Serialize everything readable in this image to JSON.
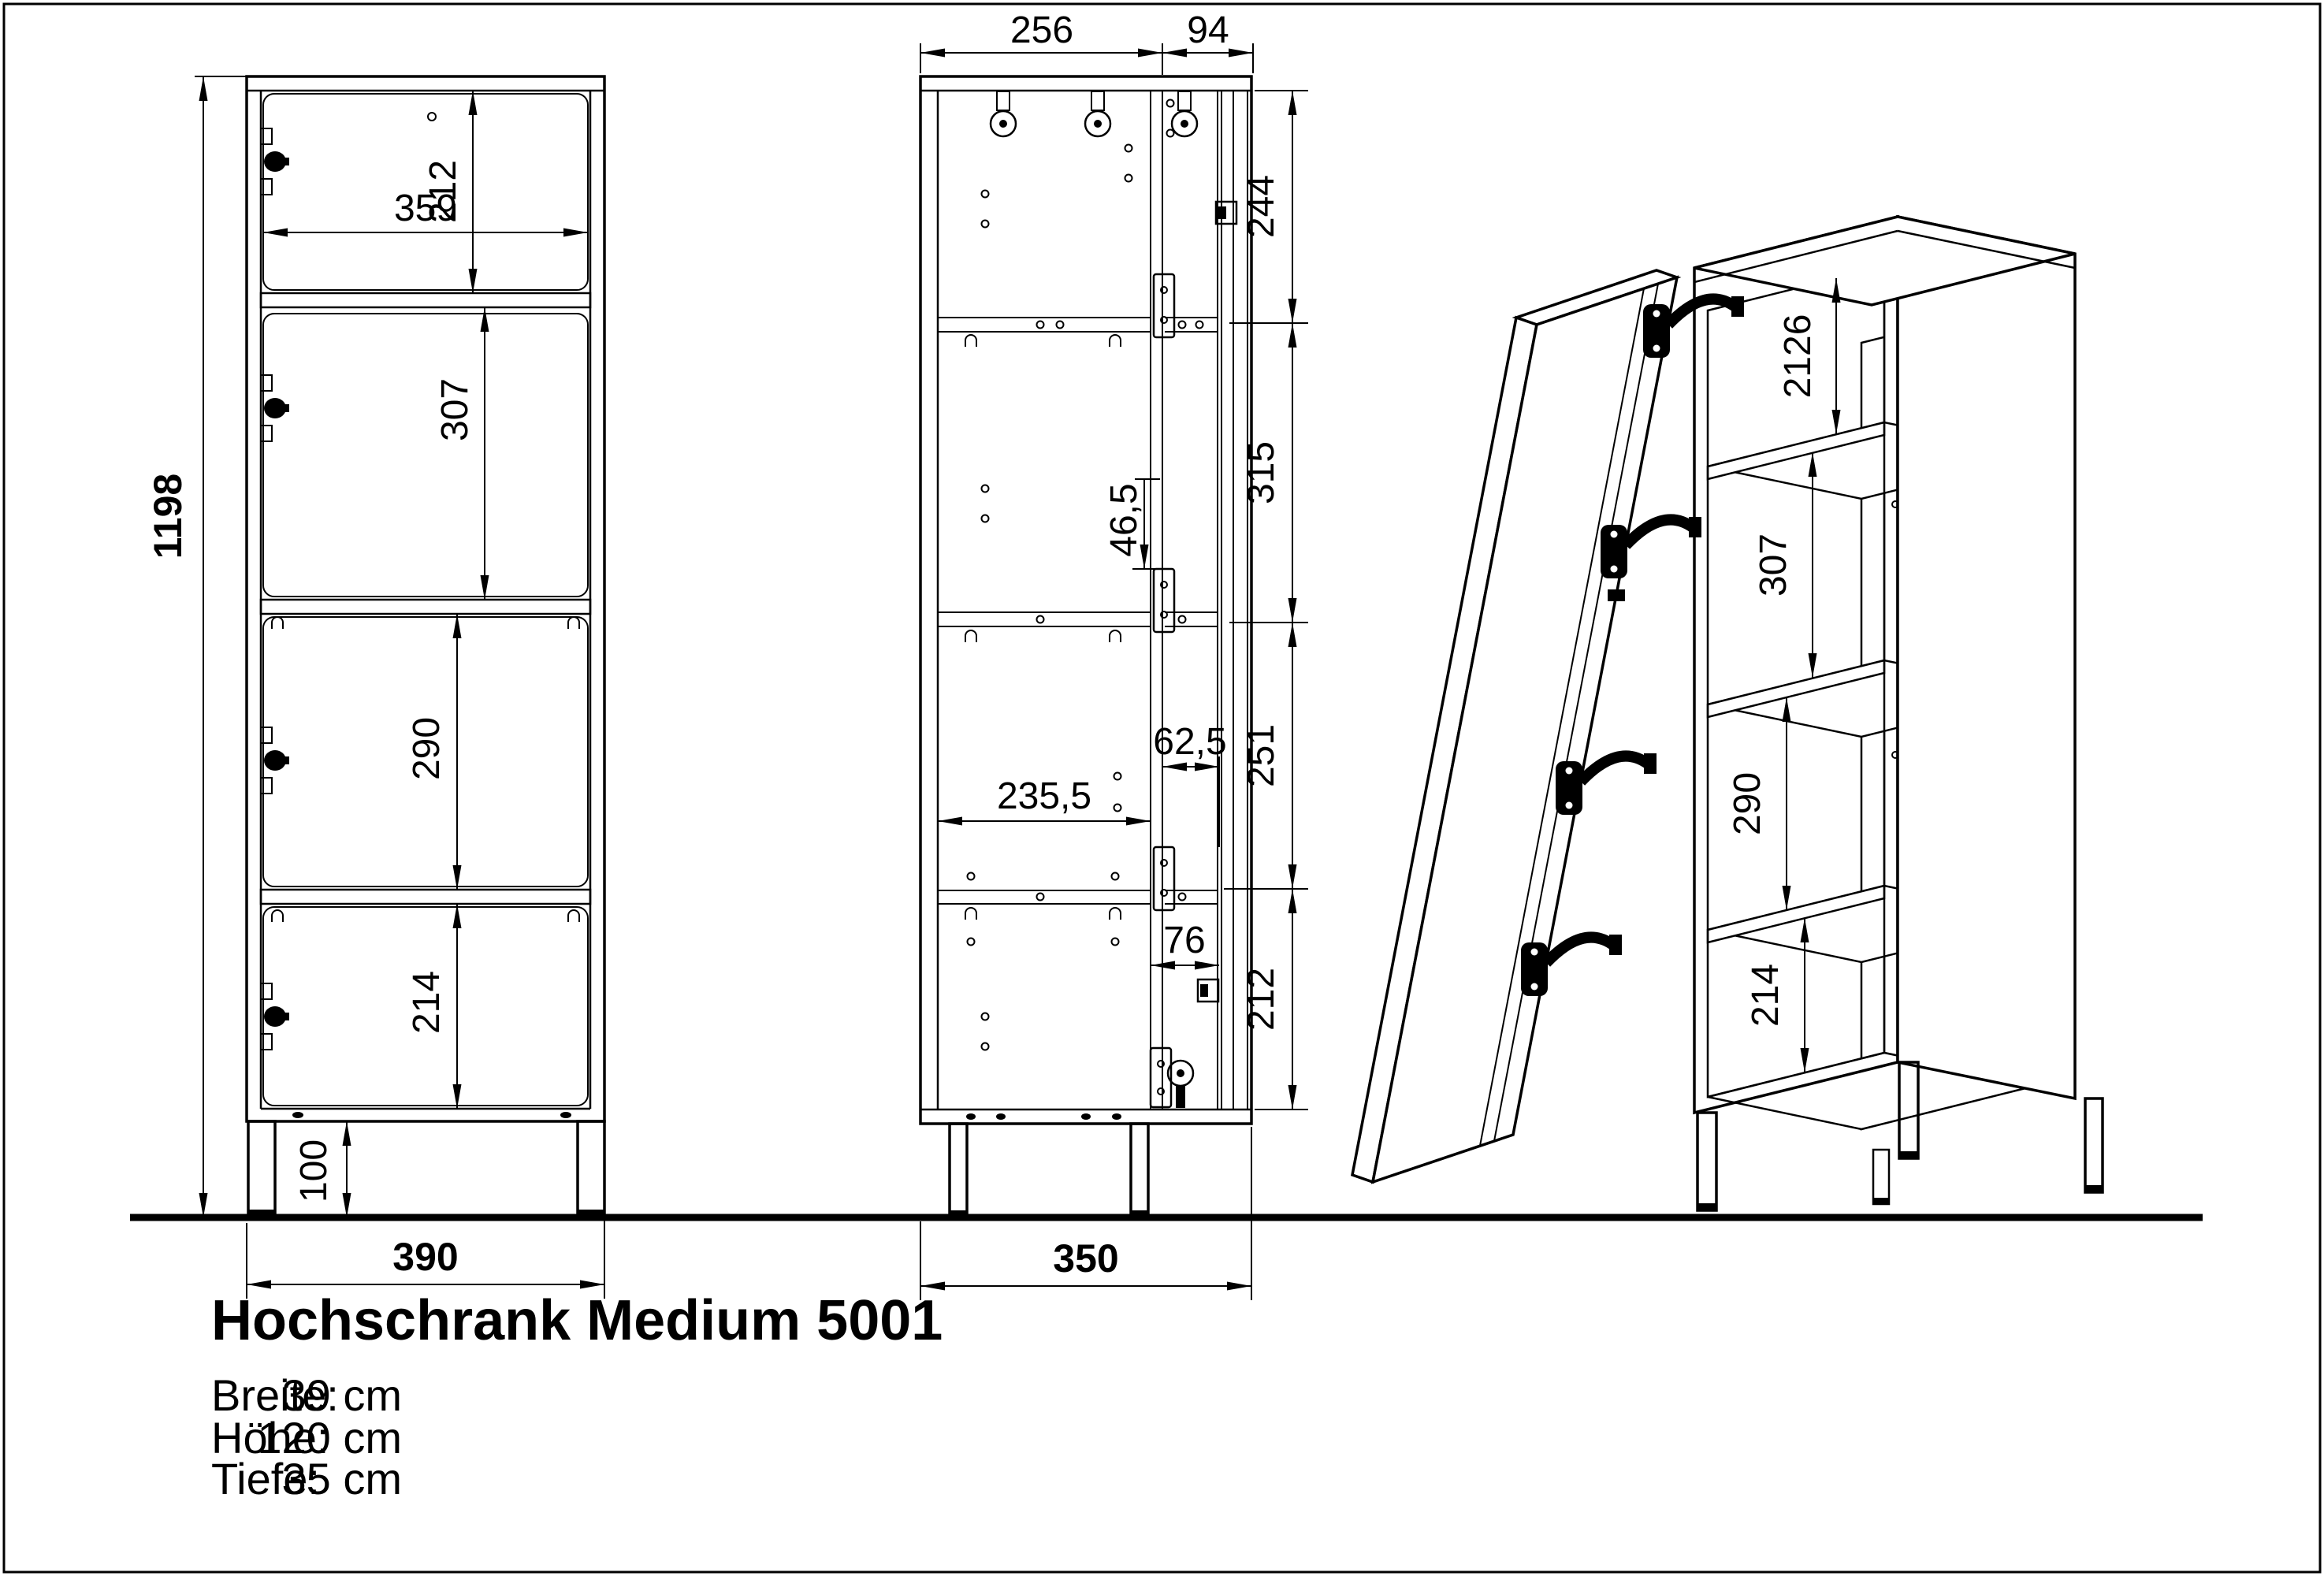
{
  "title": "Hochschrank Medium 5001",
  "specs": {
    "rows": [
      {
        "label": "Breite:",
        "value": "39 cm"
      },
      {
        "label": "Höhe:",
        "value": "120 cm"
      },
      {
        "label": "Tiefe:",
        "value": "35 cm"
      }
    ]
  },
  "front_view": {
    "total_height": "1198",
    "comp1": "212",
    "inner_width": "359",
    "comp2": "307",
    "comp3": "290",
    "comp4": "214",
    "leg_height": "100",
    "total_width": "390"
  },
  "side_view": {
    "depth_back": "256",
    "depth_front": "94",
    "seg_top": "244",
    "shelf_inset": "46,5",
    "seg_upper": "315",
    "hinge_inset": "62,5",
    "seg_lower": "251",
    "inner_depth": "235,5",
    "door_inset": "76",
    "seg_bottom": "212",
    "total_depth": "350"
  },
  "iso_view": {
    "comp1": "2126",
    "comp2": "307",
    "comp3": "290",
    "comp4": "214"
  }
}
